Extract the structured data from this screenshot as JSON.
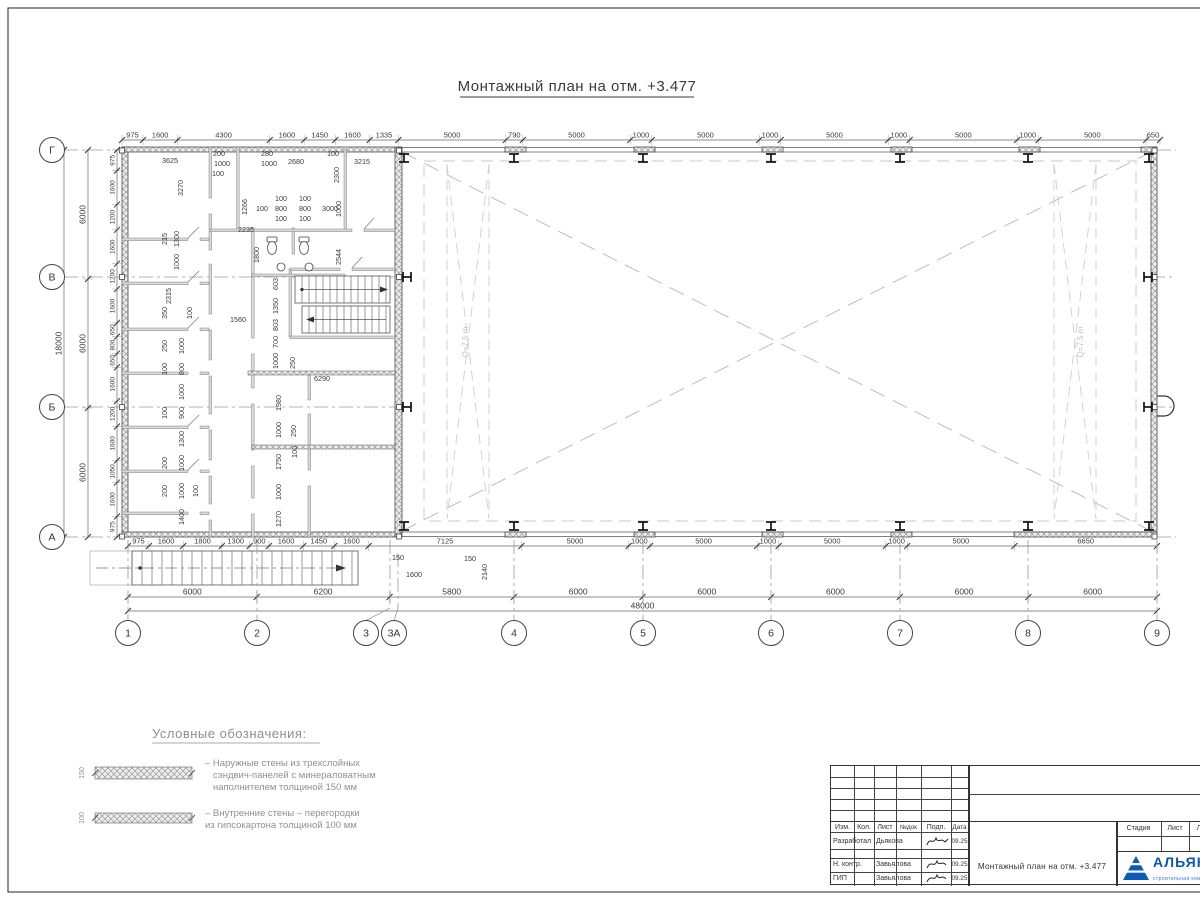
{
  "sheet": {
    "title": "Монтажный план на отм. +3.477"
  },
  "plan": {
    "axes": {
      "left": [
        "Г",
        "В",
        "Б",
        "А"
      ],
      "bottom": [
        "1",
        "2",
        "3",
        "3А",
        "4",
        "5",
        "6",
        "7",
        "8",
        "9"
      ]
    },
    "chains": {
      "top": [
        "975",
        "1600",
        "4300",
        "1600",
        "1450",
        "1600",
        "1335",
        "5000",
        "790",
        "5000",
        "1000",
        "5000",
        "1000",
        "5000",
        "1000",
        "5000",
        "1000",
        "5000",
        "650"
      ],
      "bottom1": [
        "975",
        "1600",
        "1800",
        "1300",
        "900",
        "1600",
        "1450",
        "1600",
        "7125",
        "5000",
        "1000",
        "5000",
        "1000",
        "5000",
        "1000",
        "5000",
        "6650"
      ],
      "bottom2": [
        "6000",
        "6200",
        "5800",
        "6000",
        "6000",
        "6000",
        "6000",
        "6000"
      ],
      "bottom_total": [
        "48000"
      ],
      "left_outer": [
        "6000",
        "6000",
        "6000"
      ],
      "left_total": [
        "18000"
      ],
      "left_inner": [
        "975",
        "1600",
        "1200",
        "1600",
        "1200",
        "1600",
        "650",
        "800",
        "650",
        "1600",
        "1200",
        "1600",
        "1050",
        "1600",
        "975"
      ]
    },
    "interior_dims": [
      "3625",
      "3270",
      "200",
      "1000",
      "100",
      "280",
      "1000",
      "2680",
      "100",
      "2300",
      "3215",
      "1266",
      "100",
      "100",
      "800",
      "800",
      "100",
      "100",
      "100",
      "3000",
      "1000",
      "2235",
      "1800",
      "2544",
      "215",
      "1300",
      "1000",
      "2315",
      "350",
      "100",
      "1560",
      "250",
      "1000",
      "100",
      "800",
      "1000",
      "100",
      "900",
      "1300",
      "200",
      "1000",
      "200",
      "1000",
      "100",
      "1400",
      "603",
      "1350",
      "803",
      "700",
      "1000",
      "250",
      "6290",
      "1980",
      "1000",
      "250",
      "1750",
      "100",
      "1000",
      "1270",
      "150",
      "150",
      "2140",
      "1600",
      "Q=7.5 m",
      "Q=7.5 m"
    ]
  },
  "legend": {
    "title": "Условные обозначения:",
    "items": [
      {
        "thickness": "150",
        "lines": [
          "– Наружные стены из трехслойных",
          "сэндвич-панелей с минераловатным",
          "наполнителем толщиной 150 мм"
        ]
      },
      {
        "thickness": "100",
        "lines": [
          "– Внутренние стены – перегородки",
          "из гипсокартона толщиной 100 мм"
        ]
      }
    ]
  },
  "title_block": {
    "header_cols": [
      "Изм.",
      "Кол.",
      "Лист",
      "№док",
      "Подп.",
      "Дата"
    ],
    "rows": [
      {
        "role": "Разработал",
        "name": "Дьякова",
        "date": "09.25"
      },
      {
        "role": "Н. контр.",
        "name": "Завьялова",
        "date": "09.25"
      },
      {
        "role": "ГИП",
        "name": "Завьялова",
        "date": "09.25"
      }
    ],
    "stage_cols": [
      "Стадия",
      "Лист",
      "Листов"
    ],
    "doc_title": "Монтажный план на отм. +3.477",
    "logo": {
      "name": "АЛЬЯНС",
      "subtitle": "строительная компания",
      "color": "#0d57b0"
    }
  }
}
